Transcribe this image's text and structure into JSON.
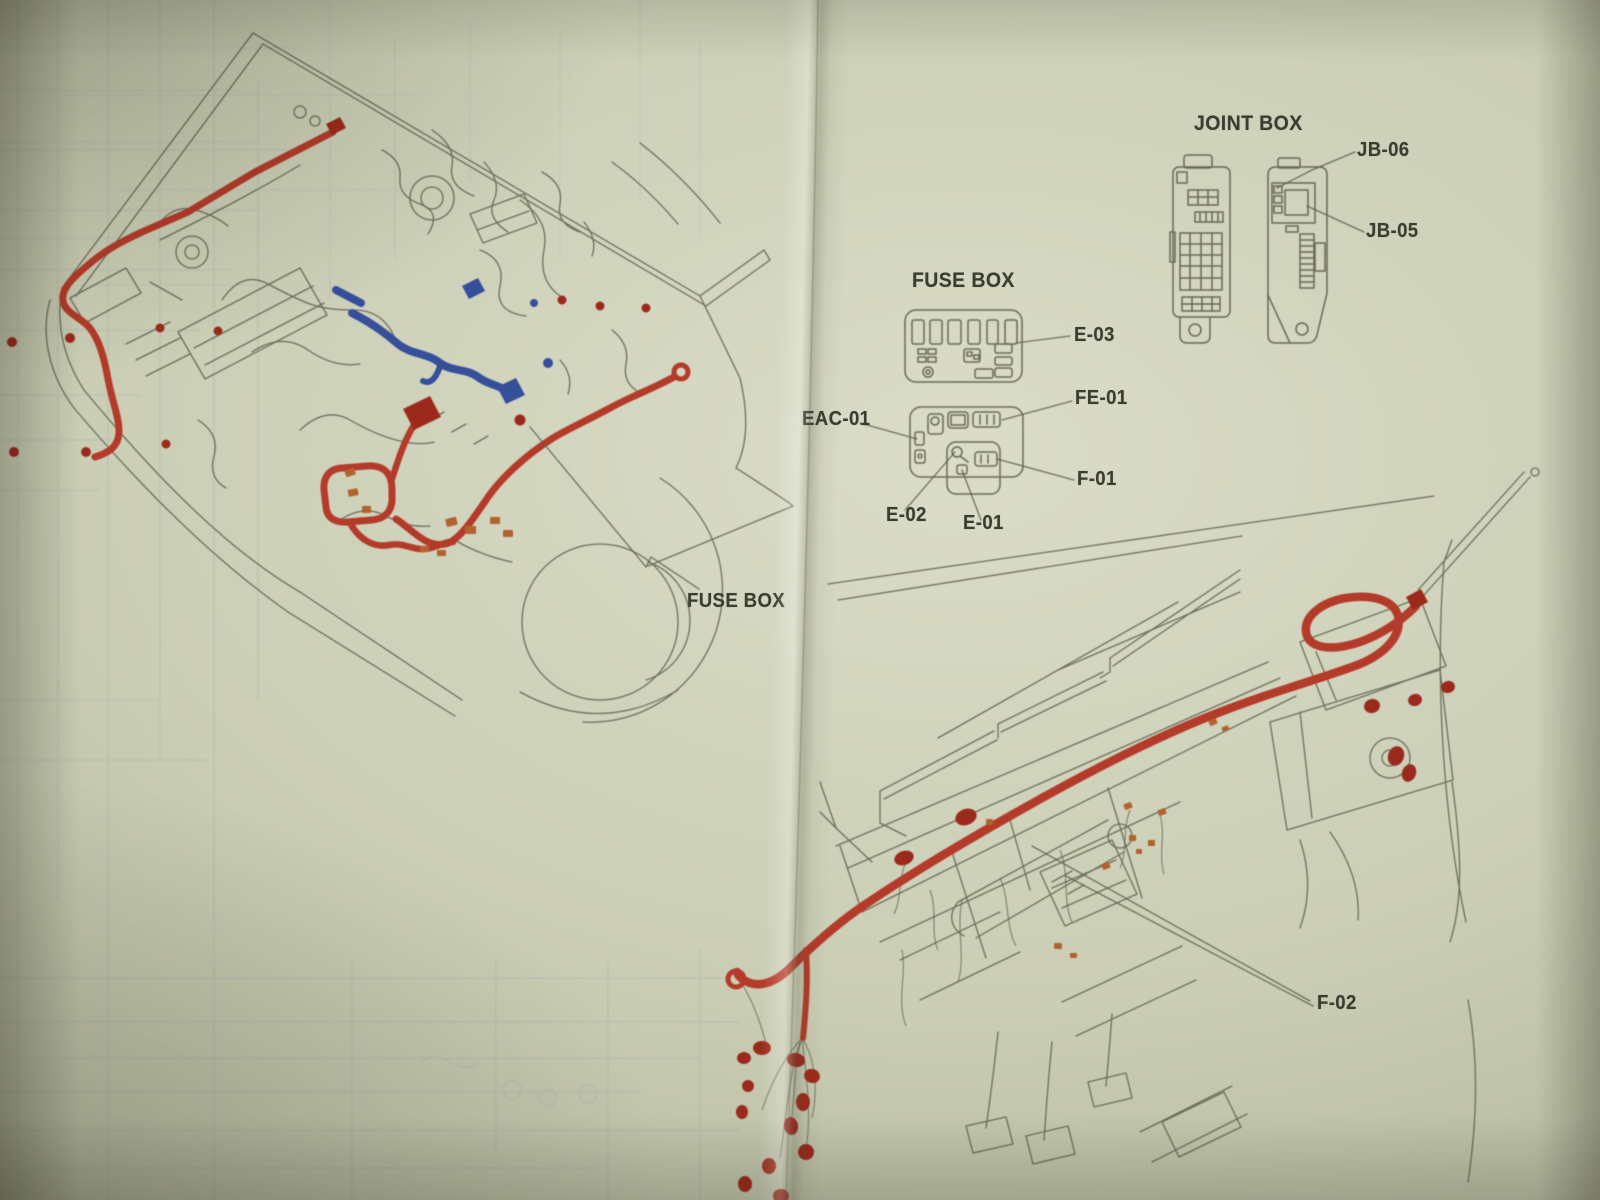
{
  "colors": {
    "paper": "#cbceb5",
    "ink": "#5d5d4c",
    "harness_red": "#b43a2c",
    "connector_red": "#9c2a1f",
    "connector_orange": "#b2622f",
    "harness_blue": "#34509b",
    "label_text": "#3c3c31",
    "show_through": "#8c97ac"
  },
  "engine_bay": {
    "callout": {
      "label": "FUSE BOX"
    }
  },
  "fuse_box_detail": {
    "title": "FUSE BOX",
    "callouts": [
      {
        "label": "E-03"
      },
      {
        "label": "EAC-01"
      },
      {
        "label": "FE-01"
      },
      {
        "label": "F-01"
      },
      {
        "label": "E-02"
      },
      {
        "label": "E-01"
      }
    ]
  },
  "joint_box_detail": {
    "title": "JOINT BOX",
    "callouts": [
      {
        "label": "JB-06"
      },
      {
        "label": "JB-05"
      }
    ]
  },
  "dashboard": {
    "callout": {
      "label": "F-02"
    }
  }
}
